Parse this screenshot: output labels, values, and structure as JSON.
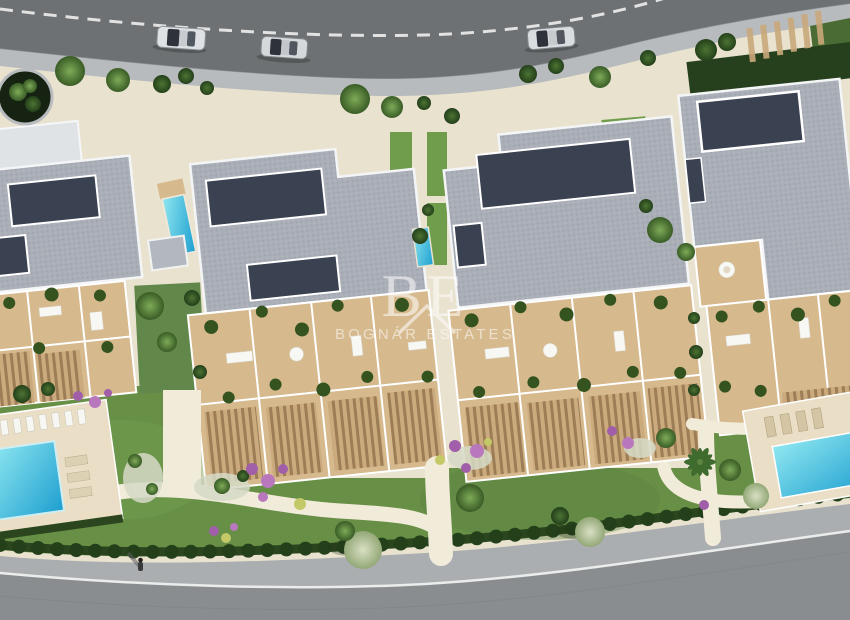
{
  "scene": {
    "description": "Aerial top-down 3D render of a residential development: four apartment blocks with grey roofs and solar panels, tan terraces with pergolas, landscaped lawns, two communal swimming pools, a curved asphalt road at top with three silver cars and a curved road at bottom with one pedestrian.",
    "watermark": {
      "monogram": "BE",
      "brand": "BOGNÁR ESTATES"
    },
    "inventory": {
      "apartment_blocks": 4,
      "cars_on_road": 3,
      "swimming_pools": 2,
      "pedestrians": 1
    },
    "colors": {
      "asphalt": "#6e7173",
      "top_sidewalk": "#b8bbbd",
      "hardscape": "#e9e2cf",
      "path": "#f1ebd9",
      "roof": "#a9aeb7",
      "solar_panel": "#3a4150",
      "terrace": "#d6ba8e",
      "lawn": "#688f46",
      "hedge": "#2b451e",
      "pool_water": "#2cb7d6",
      "pool_deck": "#eadfc6",
      "bottom_sidewalk": "#abaeb0",
      "bottom_road": "#8a8d90",
      "road_line": "#ebecec",
      "watermark_white": "#ffffff"
    }
  }
}
